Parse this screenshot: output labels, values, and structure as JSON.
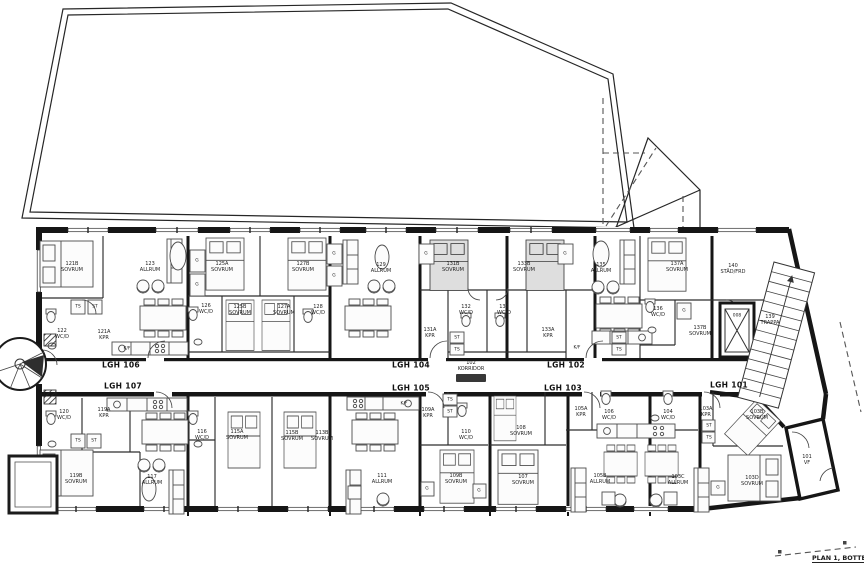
{
  "title": "PLAN 1, BOTTENPLAN",
  "apartments": {
    "a101": "LGH 101",
    "a102": "LGH 102",
    "a103": "LGH 103",
    "a104": "LGH 104",
    "a105": "LGH 105",
    "a106": "LGH 106",
    "a107": "LGH 107"
  },
  "rooms": {
    "r121b": "121B\nSOVRUM",
    "r123": "123\nALLRUM",
    "r122": "122\nWC/D",
    "r121a": "121A\nKPR",
    "r125a": "125A\nSOVRUM",
    "r127b": "127B\nSOVRUM",
    "r126": "126\nWC/D",
    "r125b": "125B\nSOVRUM",
    "r127a": "127A\nSOVRUM",
    "r128": "128\nWC/D",
    "r129": "129\nALLRUM",
    "r131b": "131B\nSOVRUM",
    "r133b": "133B\nSOVRUM",
    "r132": "132\nWC/D",
    "r134": "134\nWC/D",
    "r131a": "131A\nKPR",
    "r133a": "133A\nKPR",
    "r135": "135\nALLRUM",
    "r137a": "137A\nSOVRUM",
    "r136": "136\nWC/D",
    "r137b": "137B\nSOVRUM",
    "r140": "140\nSTÄD/FRD",
    "r139": "139\nTRAPPA",
    "r102": "102\nKORRIDOR",
    "r120": "120\nWC/D",
    "r119a": "119A\nKPR",
    "r119b": "119B\nSOVRUM",
    "r117": "117\nALLRUM",
    "r116": "116\nWC/D",
    "r115a": "115A\nSOVRUM",
    "r115b": "115B\nSOVRUM",
    "r113b": "113B\nSOVRUM",
    "r109a": "109A\nKPR",
    "r110": "110\nWC/D",
    "r108": "108\nSOVRUM",
    "r111": "111\nALLRUM",
    "r109b": "109B\nSOVRUM",
    "r107": "107\nSOVRUM",
    "r105a": "105A\nKPR",
    "r106": "106\nWC/D",
    "r104": "104\nWC/D",
    "r103a": "103A\nKPR",
    "r105b": "105B\nALLRUM",
    "r103c": "103C\nALLRUM",
    "r103b": "103B\nSOVRUM",
    "r103d": "103D\nSOVRUM",
    "r101": "101\nVF"
  },
  "marks": {
    "wardrobe": "G",
    "ts": "TS",
    "st": "ST",
    "fridge": "K/F",
    "elevator": "008"
  }
}
